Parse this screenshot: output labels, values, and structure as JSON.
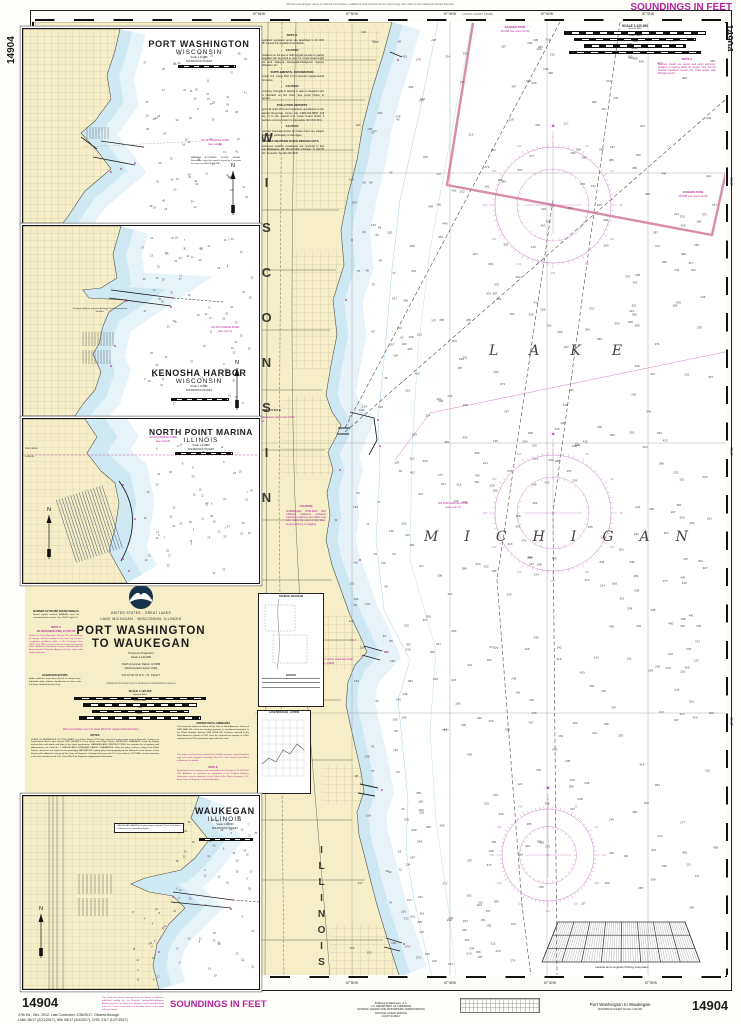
{
  "sheet": {
    "chart_number": "14904",
    "soundings_banner": "SOUNDINGS IN FEET",
    "top_note": "NOAA encourages users to submit corrections, additions and comments for improving this chart to the National Ocean Service",
    "joins_note": "(JOINS CHART 14905)",
    "edition_line1": "27th Ed., Dec. 2012.  Last Correction: 2/26/2017.  Cleared through",
    "edition_line2": "LNM: 08/17 (2/21/2017), NM: 08/17 (3/4/2017), CHS: 0117 (1/27/2017)",
    "update_note": "This chart has been corrected from the Notice to Mariners published weekly by the National Geospatial-Intelligence Agency and the Local Notice to Mariners issued periodically by each U.S. Coast Guard district to the date shown in the lower left hand corner.",
    "publisher": [
      "Published at Washington, D.C.",
      "U.S. DEPARTMENT OF COMMERCE",
      "NATIONAL OCEANIC AND ATMOSPHERIC ADMINISTRATION",
      "NATIONAL OCEAN SERVICE",
      "COAST SURVEY"
    ],
    "footer_title": "Port Washington to Waukegan",
    "footer_sub": "SOUNDINGS IN FEET  SCALE 1:120,000"
  },
  "title_block": {
    "region1": "UNITED STATES - GREAT LAKES",
    "region2": "LAKE MICHIGAN - WISCONSIN, ILLINOIS",
    "title1": "PORT WASHINGTON",
    "title2": "TO WAUKEGAN",
    "projection": "Polyconic Projection",
    "scale": "Scale 1:120,000",
    "datum1": "North American Datum of 1983",
    "datum2": "(World Geodetic System 1984)",
    "soundings": "SOUNDINGS IN FEET",
    "info": "Additional information can be obtained at nauticalcharts.noaa.gov",
    "mrass_heading": "MARINER ACTIVATED SOUND SIGNALS",
    "mrass_body": "Sound signals marked (MRASS) must be activated by the mariner. See USCG Light List.",
    "note_s_heading": "NOTE S",
    "note_s_sub": "NO DISCHARGE ZONE, 40 CFR 140",
    "note_s_body": "Under the Clean Water Act, Section 312, the discharge of sewage, whether treated or not, from any vessel is completely prohibited within a No Discharge Zone (NDZ). The NDZs on this chart are shown by magenta notes. Additional information may be obtained from the Environmental Protection Agency and the state water quality agencies.",
    "radar_heading": "RADAR REFLECTORS",
    "radar_body": "Radar reflectors have been placed on many buoys. Individual radar reflector identification on these aids has been omitted from this chart.",
    "facilities_note": "Plans and facilities: see U.S. Coast Pilot 6 for supplemental information.",
    "notes_heading": "NOTES",
    "notes_body": "PLANE OF REFERENCE OF THIS CHART: Low Water Datum 577.5 feet, referred to mean water level at Rimouski, Quebec, on International Great Lakes Datum 1985. HEIGHTS in feet above Low Water Datum. IMPROVED CHANNELS shown by limiting dashed lines with depth and date of the latest examination. DANGERS AND OBSTRUCTIONS: for complete list of symbols and abbreviations see Chart No. 1. BRIDGE AND OVERHEAD CABLE CLEARANCES: when the water surface is above Low Water Datum, clearances are reduced correspondingly. NAVIGATION: hydrography and topography by the National Ocean Service, Coast Survey, with additional surveys by the Corps of Engineers, Geological Survey, and U.S. Coast Guard. CULTURE: vessels operating in this area should consult U.S. Coast Pilot 6 for important supplemental information.",
    "landmarks_heading": "CONSPICUOUS LANDMARKS",
    "landmarks_body": "The horizontal reference datum of this chart is North American Datum of 1983 (NAD 83), which for charting purposes is considered equivalent to the World Geodetic System 1984 (WGS 84). Positions referred to the North American Datum of 1927 must be corrected an average of 0.064' northward and 0.28' eastward to agree with this chart.",
    "stability_note": "The paper used has been selected for stability; however, slight distortions may occur with changes in humidity. See U.S. Coast Guard Local Notice to Mariners for details.",
    "note_b_heading": "NOTE B",
    "note_b_body": "Regulations for the danger zones are published in Chapter II, 33 CFR Part 334. Additions or revisions are published in the Federal Register. Information may be obtained at the Office of the District Engineer, U.S. Army Corps of Engineers, Detroit, Michigan."
  },
  "scale_block": {
    "title": "SCALE 1:120,000",
    "rows": [
      "Nautical Miles",
      "Statute Miles",
      "Yards",
      "Meters"
    ]
  },
  "insets": [
    {
      "name": "PORT WASHINGTON",
      "state": "WISCONSIN",
      "scale": "Scale 1:10,000",
      "soundings": "SOUNDINGS IN FEET",
      "ndz1": "NO DISCHARGE ZONE",
      "ndz2": "(see note S)",
      "note": "MARINER ACTIVATED SOUND SIGNAL: Breakwater Light fog signal is keyed by 5 seconds of carrier on VHF-FM Ch 83A.",
      "north": "N"
    },
    {
      "name": "KENOSHA HARBOR",
      "state": "WISCONSIN",
      "scale": "Scale 1:10,000",
      "soundings": "SOUNDINGS IN FEET",
      "ndz1": "NO DISCHARGE ZONE",
      "ndz2": "(see note S)",
      "note": "Southport Marina: transient dockage, fuel and pump-out facilities.",
      "north": "N"
    },
    {
      "name": "NORTH POINT MARINA",
      "state": "ILLINOIS",
      "scale": "Scale 1:10,000",
      "soundings": "SOUNDINGS IN FEET",
      "ndz1": "NO DISCHARGE ZONE",
      "ndz2": "(see note B)",
      "state_top": "WISCONSIN",
      "state_bottom": "ILLINOIS",
      "north": "N"
    },
    {
      "name": "WAUKEGAN",
      "state": "ILLINOIS",
      "scale": "Scale 1:10,000",
      "soundings": "SOUNDINGS IN FEET",
      "note": "WAUKEGAN HARBOR: Federal project depth 12 feet. See Notice to Mariners for controlling depths.",
      "north": "N"
    }
  ],
  "main_chart": {
    "lake": "LAKE",
    "michigan": "MICHIGAN",
    "state_upper": "WISCONSIN",
    "state_lower": "ILLINOIS",
    "milwaukee": "MILWAUKEE",
    "see_milwaukee": "For Milwaukee Harbor see Chart 14924",
    "see_racine": "For harbor detail see Chart No. 14828",
    "ndz1": "NO DISCHARGE ZONE",
    "ndz2": "(see note S)",
    "danger": "DANGER ZONE",
    "danger_sub": "334.845 (see note A and B)",
    "note_a_heading": "NOTE A",
    "note_a_body": "Mariners should use caution and avoid anchoring, dredging or trawling within the danger zone. For the Federal regulations consult U.S. Coast Guard, Lake Michigan sector.",
    "interpolator": "Latitude and Longitude Plotting Interpolator",
    "top_lons": [
      "87°55'W",
      "87°50'W",
      "87°45'W",
      "87°40'W",
      "87°35'W"
    ],
    "bottom_lons": [
      "87°50'W",
      "87°45'W",
      "87°40'W",
      "87°35'W"
    ],
    "right_lats": [
      "43°15'",
      "43°00'",
      "42°45'"
    ],
    "land_notes": [
      {
        "h": "NOTE D",
        "b": "Regulated navigation areas are described in 33 CFR 165; consult the regulations for details."
      },
      {
        "h": "CAUTION",
        "b": "Limitations on the use of radio signals as aids to marine navigation can be found in the U.S. Coast Guard Light Lists and National Geospatial-Intelligence Agency Publication 117."
      },
      {
        "h": "SUPPLEMENTAL INFORMATION",
        "b": "Consult U.S. Coast Pilot 6 for important supplemental information."
      },
      {
        "h": "CAUTION",
        "b": "Temporary changes or defects in aids to navigation are not indicated on this chart. See Local Notice to Mariners."
      },
      {
        "h": "POLLUTION REPORTS",
        "b": "Report all spills of oil and hazardous substances to the National Response Center via 1-800-424-8802 (toll free), or to the nearest U.S. Coast Guard facility if telephone communication is impossible (33 CFR 153)."
      },
      {
        "h": "CAUTION",
        "b": "Improved channels shown by broken lines are subject to shoaling, particularly at the edges."
      },
      {
        "h": "NOAA WEATHER RADIO BROADCASTS",
        "b": "Continuous weather broadcasts are received in this area: Milwaukee, WI 162.40 MHz; Chicago, IL 162.55 MHz; Kenosha, WI 162.425 MHz."
      }
    ],
    "pipeline_caution_h": "CAUTION",
    "pipeline_caution_b": "SUBMERGED PIPELINES AND CABLES: additional uncharted submarine pipelines and cables may exist within the area of this chart. Avoid anchoring or dragging.",
    "source_box_title": "SOURCE DIAGRAM",
    "source_box_sub": "SOURCE",
    "lake_levels_title": "LAKE MICHIGAN - HURON"
  },
  "soundings_cfg": {
    "regions": [
      {
        "target": "snd-main",
        "x": 402,
        "y": 30,
        "w": 315,
        "h": 880,
        "count": 380,
        "min": 180,
        "max": 460,
        "seed": 7
      },
      {
        "target": "snd-main",
        "x": 348,
        "y": 30,
        "w": 54,
        "h": 930,
        "count": 85,
        "min": 20,
        "max": 180,
        "seed": 11
      },
      {
        "target": "snd-main",
        "x": 402,
        "y": 912,
        "w": 120,
        "h": 55,
        "count": 26,
        "min": 160,
        "max": 380,
        "seed": 13
      },
      {
        "target": "snd-pw",
        "x": 118,
        "y": 24,
        "w": 110,
        "h": 158,
        "count": 72,
        "min": 8,
        "max": 42,
        "seed": 3
      },
      {
        "target": "snd-ken",
        "x": 118,
        "y": 12,
        "w": 112,
        "h": 168,
        "count": 80,
        "min": 6,
        "max": 38,
        "seed": 4
      },
      {
        "target": "snd-npm",
        "x": 120,
        "y": 26,
        "w": 110,
        "h": 130,
        "count": 58,
        "min": 5,
        "max": 30,
        "seed": 5
      },
      {
        "target": "snd-wau",
        "x": 152,
        "y": 12,
        "w": 80,
        "h": 172,
        "count": 56,
        "min": 5,
        "max": 32,
        "seed": 6
      },
      {
        "target": "snd-wau",
        "x": 104,
        "y": 112,
        "w": 56,
        "h": 74,
        "count": 22,
        "min": 4,
        "max": 18,
        "seed": 8
      }
    ]
  }
}
